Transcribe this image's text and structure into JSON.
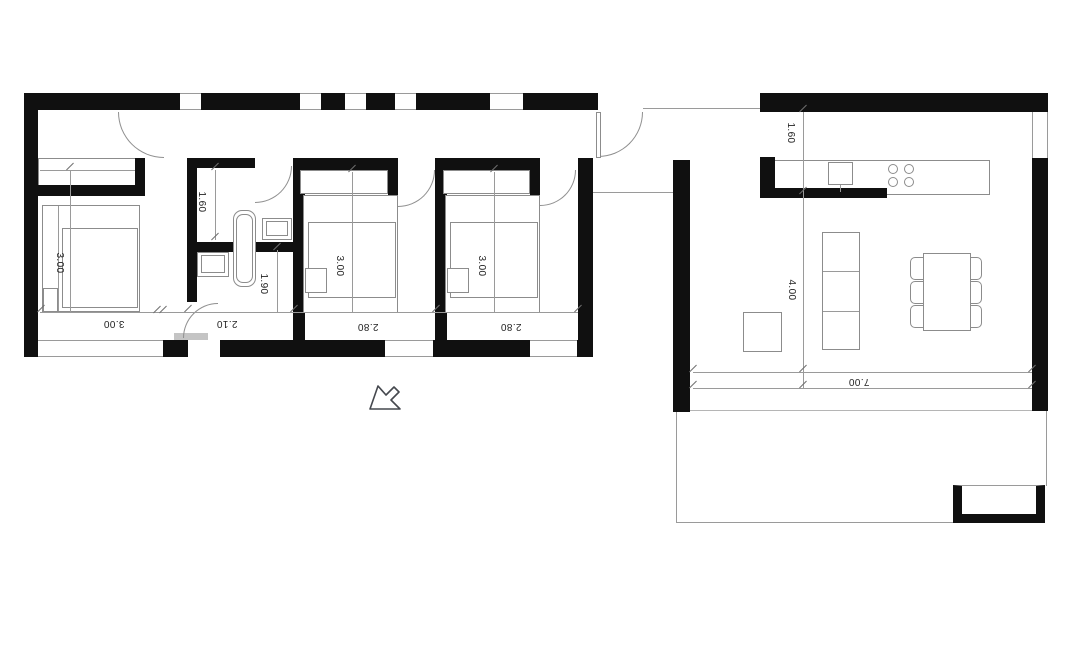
{
  "plan": {
    "title": "single-storey house floor plan",
    "labels": {
      "bedroom1_depth": "3.00",
      "bedroom1_width": "3.00",
      "bathroom_width": "1.60",
      "bathroom_length": "1.90",
      "hallway_width": "2.10",
      "bedroom2_depth": "3.00",
      "bedroom2_width": "2.80",
      "bedroom3_depth": "3.00",
      "bedroom3_width": "2.80",
      "kitchen_offset": "1.60",
      "living_depth": "4.00",
      "living_width": "7.00"
    },
    "colors": {
      "wall": "#101010",
      "thin_line": "#9a9a9a",
      "furniture_line": "#8c8c8c",
      "text": "#222222",
      "background": "#ffffff"
    },
    "icons": {
      "cursor": "arrow-pointer"
    }
  }
}
